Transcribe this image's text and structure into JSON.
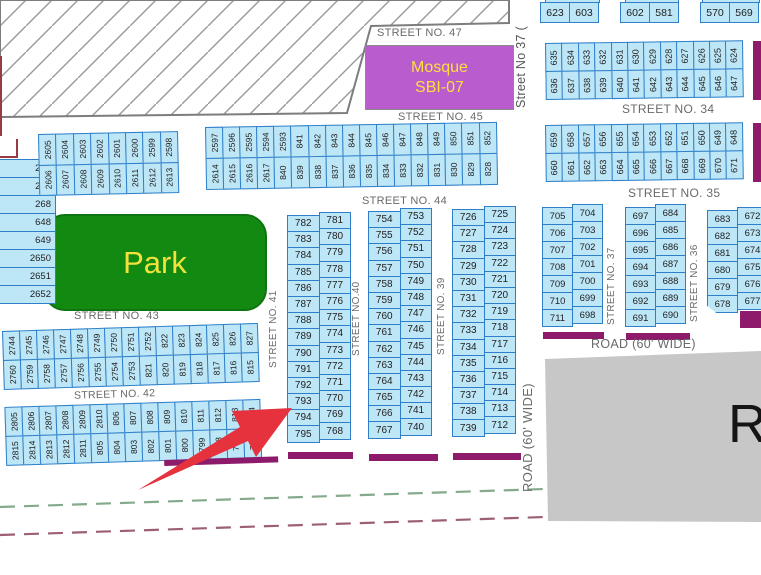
{
  "labels": {
    "street47": "STREET NO. 47",
    "street45": "STREET NO. 45",
    "street44": "STREET NO. 44",
    "street43": "STREET NO. 43",
    "street42": "STREET NO. 42",
    "street34": "STREET NO. 34",
    "street35": "STREET NO. 35",
    "street37_top": "Street No 37 (",
    "street37": "STREET NO. 37",
    "street36": "STREET NO. 36",
    "street41": "STREET NO. 41",
    "street40": "STREET NO.40",
    "street39": "STREET NO. 39",
    "road_horizontal": "ROAD (60' WIDE)",
    "road_vertical": "ROAD (60' WIDE)",
    "road_block": "Ro",
    "park": "Park",
    "mosque_line1": "Mosque",
    "mosque_line2": "SBI-07"
  },
  "colors": {
    "plot_fill": "#BDE6F7",
    "plot_border": "#2E7FC8",
    "maroon_strip": "#8E1A6B",
    "park_green": "#128A12",
    "mosque_purple": "#B85CCE",
    "label_yellow": "#F2E23B",
    "arrow_red": "#E5323C",
    "road_gray": "#C7C7C7",
    "dash_green": "#84A98C",
    "dash_maroon": "#9C5F76"
  },
  "top_right": {
    "p1_left": "623",
    "p1_right": "603",
    "p2_left": "602",
    "p2_right": "581",
    "p3_left": "570",
    "p3_right": "569"
  },
  "plots": {
    "b34_top": [
      "635",
      "634",
      "633",
      "632",
      "631",
      "630",
      "629",
      "628",
      "627",
      "626",
      "625",
      "624"
    ],
    "b34_bottom": [
      "636",
      "637",
      "638",
      "639",
      "640",
      "641",
      "642",
      "643",
      "644",
      "645",
      "646",
      "647"
    ],
    "b35_top": [
      "659",
      "658",
      "657",
      "656",
      "655",
      "654",
      "653",
      "652",
      "651",
      "650",
      "649",
      "648"
    ],
    "b35_bottom": [
      "660",
      "661",
      "662",
      "663",
      "664",
      "665",
      "666",
      "667",
      "668",
      "669",
      "670",
      "671"
    ],
    "r1_left": [
      "705",
      "706",
      "707",
      "708",
      "709",
      "710",
      "711"
    ],
    "r1_right": [
      "704",
      "703",
      "702",
      "701",
      "700",
      "699",
      "698"
    ],
    "r2_left": [
      "697",
      "696",
      "695",
      "694",
      "693",
      "692",
      "691"
    ],
    "r2_right": [
      "684",
      "685",
      "686",
      "687",
      "688",
      "689",
      "690"
    ],
    "r3_left": [
      "683",
      "682",
      "681",
      "680",
      "679",
      "678"
    ],
    "r3_right": [
      "672",
      "673",
      "674",
      "675",
      "676",
      "677"
    ],
    "left_edge": [
      "266",
      "267",
      "268",
      "648",
      "649",
      "2650",
      "2651",
      "2652"
    ],
    "b2605_top": [
      "2605",
      "2604",
      "2603",
      "2602",
      "2601",
      "2600",
      "2599",
      "2598"
    ],
    "b2605_bottom": [
      "2606",
      "2607",
      "2608",
      "2609",
      "2610",
      "2611",
      "2612",
      "2613"
    ],
    "b44_top": [
      "2597",
      "2596",
      "2595",
      "2594",
      "2593",
      "841",
      "842",
      "843",
      "844",
      "845",
      "846",
      "847",
      "848",
      "849",
      "850",
      "851",
      "852"
    ],
    "b44_bottom": [
      "2614",
      "2615",
      "2616",
      "2617",
      "840",
      "839",
      "838",
      "837",
      "836",
      "835",
      "834",
      "833",
      "832",
      "831",
      "830",
      "829",
      "828"
    ],
    "m1_left": [
      "782",
      "783",
      "784",
      "785",
      "786",
      "787",
      "788",
      "789",
      "790",
      "791",
      "792",
      "793",
      "794",
      "795"
    ],
    "m1_right": [
      "781",
      "780",
      "779",
      "778",
      "777",
      "776",
      "775",
      "774",
      "773",
      "772",
      "771",
      "770",
      "769",
      "768"
    ],
    "m2_left": [
      "754",
      "755",
      "756",
      "757",
      "758",
      "759",
      "760",
      "761",
      "762",
      "763",
      "764",
      "765",
      "766",
      "767"
    ],
    "m2_right": [
      "753",
      "752",
      "751",
      "750",
      "749",
      "748",
      "747",
      "746",
      "745",
      "744",
      "743",
      "742",
      "741",
      "740"
    ],
    "m3_left": [
      "726",
      "727",
      "728",
      "729",
      "730",
      "731",
      "732",
      "733",
      "734",
      "735",
      "736",
      "737",
      "738",
      "739"
    ],
    "m3_right": [
      "725",
      "724",
      "723",
      "722",
      "721",
      "720",
      "719",
      "718",
      "717",
      "716",
      "715",
      "714",
      "713",
      "712"
    ],
    "sw_rowA": [
      "2744",
      "2745",
      "2746",
      "2747",
      "2748",
      "2749",
      "2750",
      "2751",
      "2752",
      "822",
      "823",
      "824",
      "825",
      "826",
      "827"
    ],
    "sw_rowB": [
      "2760",
      "2759",
      "2758",
      "2757",
      "2756",
      "2755",
      "2754",
      "2753",
      "821",
      "820",
      "819",
      "818",
      "817",
      "816",
      "815"
    ],
    "sw_rowC": [
      "2805",
      "2806",
      "2807",
      "2808",
      "2809",
      "2810",
      "806",
      "807",
      "808",
      "809",
      "810",
      "811",
      "812",
      "813",
      "814"
    ],
    "sw_rowD": [
      "2815",
      "2814",
      "2813",
      "2812",
      "2811",
      "805",
      "804",
      "803",
      "802",
      "801",
      "800",
      "799",
      "798",
      "797",
      "796"
    ]
  }
}
